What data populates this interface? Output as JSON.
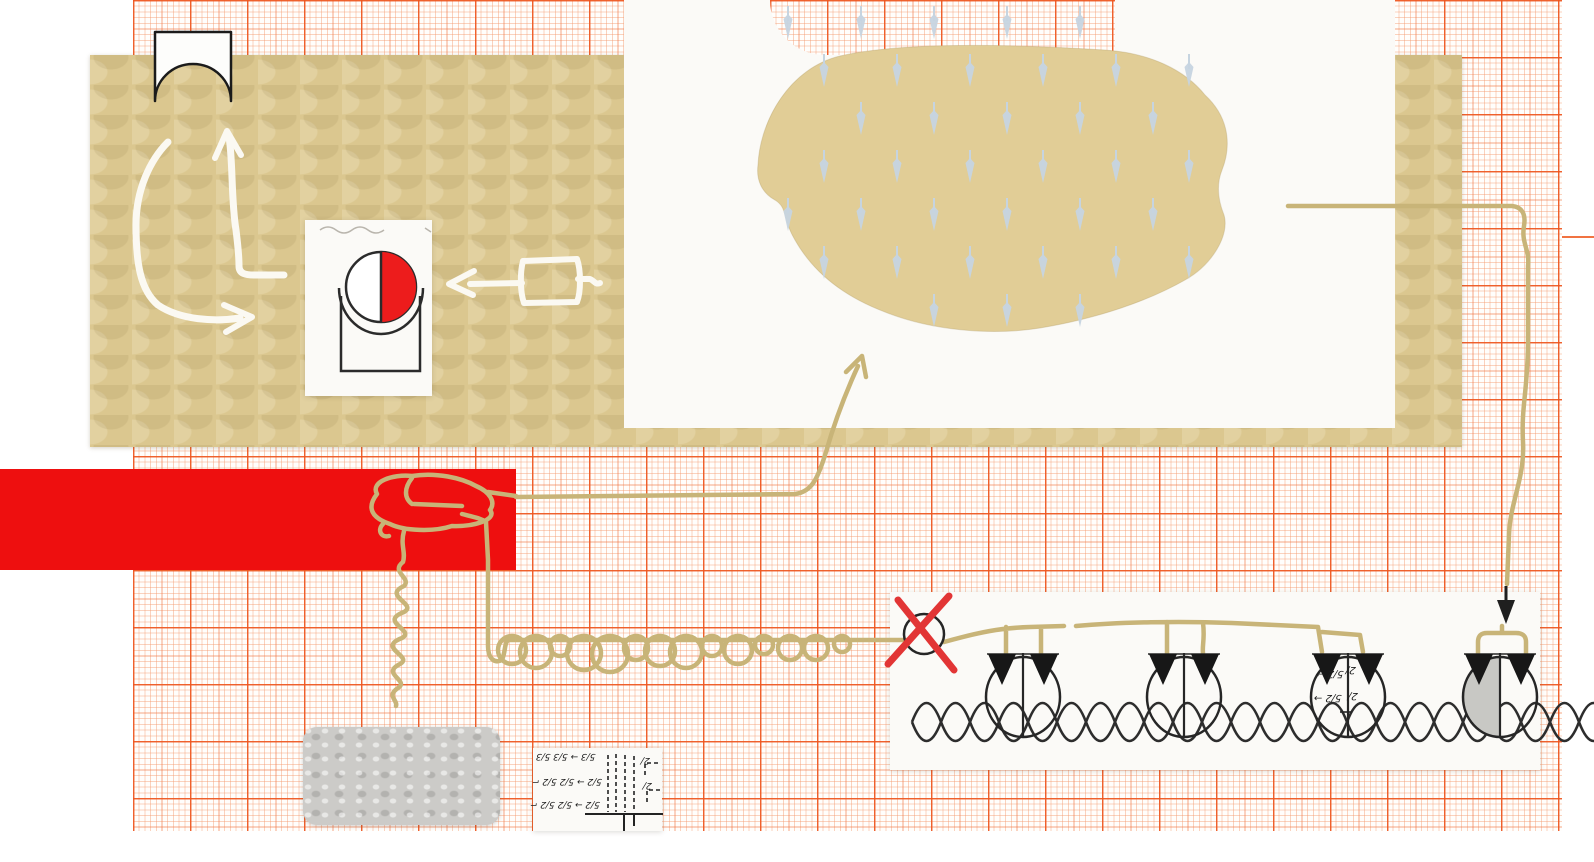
{
  "artwork": {
    "title": "collage schematic on millimeter graph paper",
    "labels": {
      "valve3_left": [
        "5/2 →",
        "5/2 →"
      ],
      "valve3_right": [
        "2/",
        "2/"
      ],
      "mini_rows": [
        "5/3 → 5/3  5/3",
        "5/2 → 5/2  5/2 ⌐",
        "5/2 → 5/2  5/2 ⌐"
      ],
      "mini_right": [
        "2/",
        "2/"
      ]
    },
    "palette": {
      "graph_orange": "#ef5a20",
      "beige_paper": "#dbc78f",
      "blob_beige": "#e1cd96",
      "tan_line": "#c8b478",
      "red_block": "#ee0f0f",
      "ball_red": "#ed1c1c",
      "x_red": "#e23535",
      "ink_black": "#262626",
      "white_ink": "#fbf9f2",
      "rain_arrow": "#c6d4e0",
      "gray_patch": "#cccbc8"
    },
    "rain_grid": {
      "row_y": [
        6,
        54,
        102,
        150,
        198,
        246,
        294
      ],
      "x_start": 788,
      "x_step": 73,
      "row_offset": 36,
      "x_count": 7
    },
    "valves": {
      "centers_x": [
        1023,
        1184,
        1348,
        1500
      ],
      "center_y": 697,
      "rx": 37,
      "ry": 40,
      "gray_half_index": 3
    },
    "coil_loops": [
      [
        512,
        14
      ],
      [
        536,
        16
      ],
      [
        560,
        10
      ],
      [
        584,
        17
      ],
      [
        610,
        18
      ],
      [
        636,
        12
      ],
      [
        660,
        15
      ],
      [
        686,
        16
      ],
      [
        712,
        10
      ],
      [
        738,
        14
      ],
      [
        764,
        9
      ],
      [
        790,
        12
      ],
      [
        816,
        12
      ],
      [
        842,
        8
      ]
    ],
    "braid": {
      "x_start": 912,
      "x_end": 1600,
      "y": 722,
      "amplitude": 19,
      "segment": 29
    }
  }
}
